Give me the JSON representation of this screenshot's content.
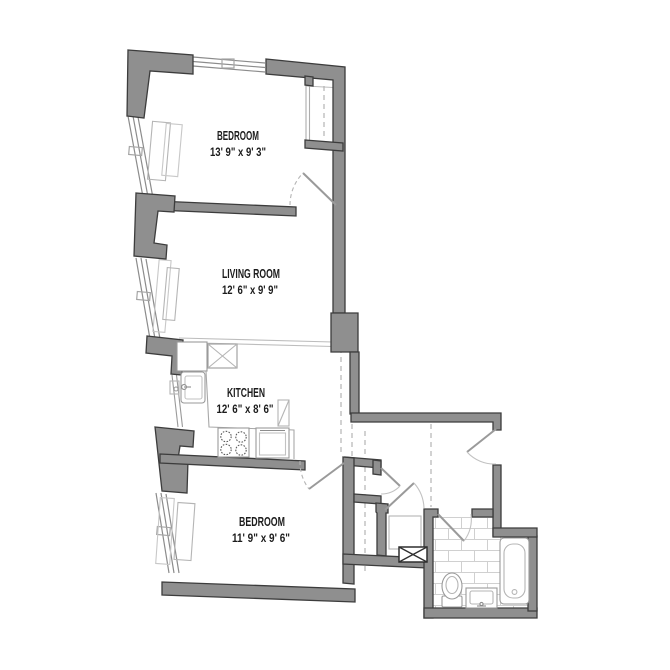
{
  "plan": {
    "type": "apartment-floor-plan",
    "colors": {
      "background": "#ffffff",
      "wall_fill": "#8f8f8f",
      "wall_outline": "#3c3c3c",
      "thin_line": "#9a9a9a",
      "light_line": "#bdbdbd",
      "tile_line": "#d0d0d0",
      "text": "#1c1c1c"
    },
    "rooms": [
      {
        "id": "bedroom-1",
        "label": "BEDROOM",
        "dims": "13' 9\" x 9' 3\""
      },
      {
        "id": "living-room",
        "label": "LIVING ROOM",
        "dims": "12' 6\" x 9' 9\""
      },
      {
        "id": "kitchen",
        "label": "KITCHEN",
        "dims": "12' 6\" x 8' 6\""
      },
      {
        "id": "bedroom-2",
        "label": "BEDROOM",
        "dims": "11' 9\" x 9' 6\""
      }
    ]
  }
}
